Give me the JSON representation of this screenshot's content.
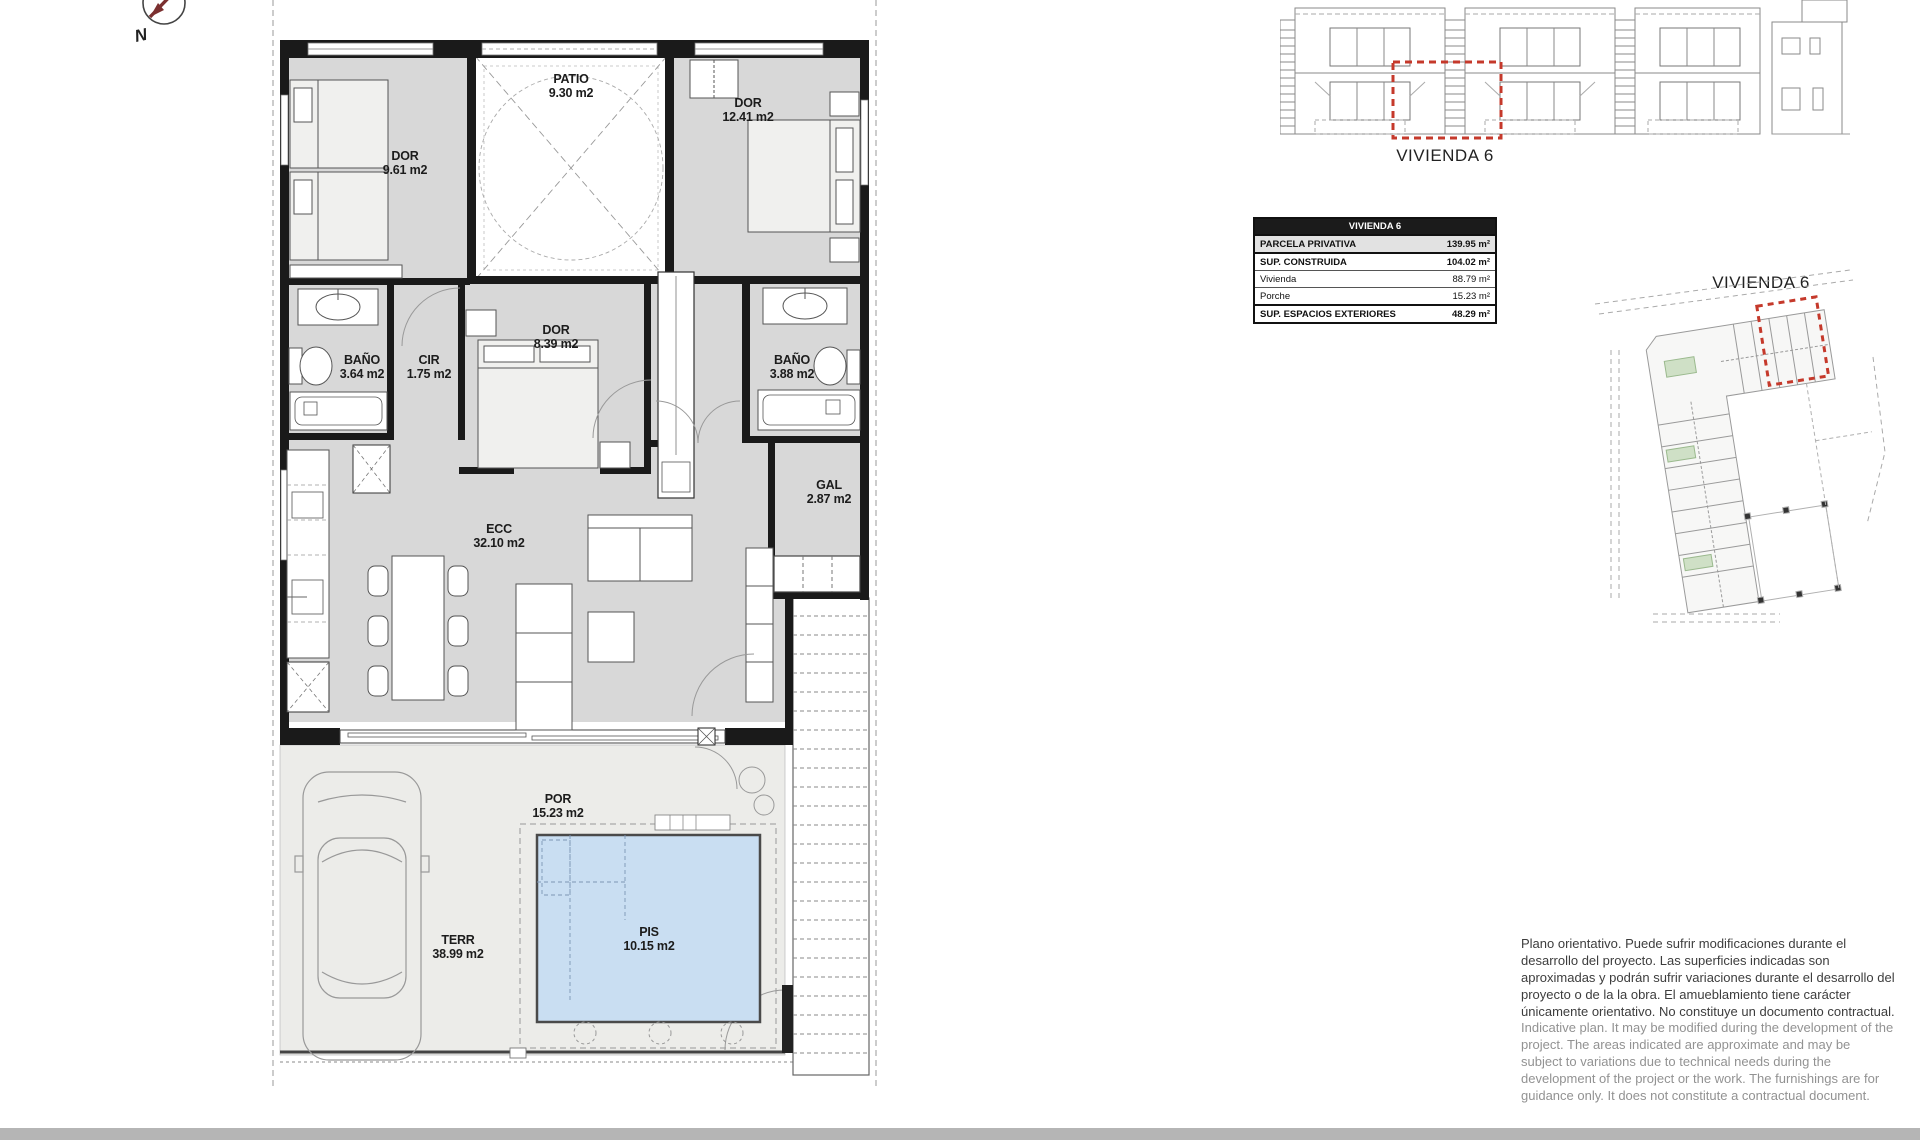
{
  "compass": {
    "north_label": "N"
  },
  "plan": {
    "rooms": [
      {
        "name": "DOR",
        "area": "9.61 m2"
      },
      {
        "name": "PATIO",
        "area": "9.30 m2"
      },
      {
        "name": "DOR",
        "area": "12.41 m2"
      },
      {
        "name": "DOR",
        "area": "8.39 m2"
      },
      {
        "name": "BAÑO",
        "area": "3.64 m2"
      },
      {
        "name": "CIR",
        "area": "1.75 m2"
      },
      {
        "name": "BAÑO",
        "area": "3.88 m2"
      },
      {
        "name": "GAL",
        "area": "2.87 m2"
      },
      {
        "name": "ECC",
        "area": "32.10 m2"
      },
      {
        "name": "POR",
        "area": "15.23 m2"
      },
      {
        "name": "TERR",
        "area": "38.99 m2"
      },
      {
        "name": "PIS",
        "area": "10.15 m2"
      }
    ]
  },
  "elevation": {
    "caption": "VIVIENDA 6"
  },
  "site_plan": {
    "caption": "VIVIENDA 6"
  },
  "summary_table": {
    "header": "VIVIENDA 6",
    "rows": [
      {
        "label": "PARCELA PRIVATIVA",
        "value": "139.95 m²"
      },
      {
        "label": "SUP. CONSTRUIDA",
        "value": "104.02 m²"
      },
      {
        "label": "Vivienda",
        "value": "88.79 m²"
      },
      {
        "label": "Porche",
        "value": "15.23 m²"
      },
      {
        "label": "SUP. ESPACIOS EXTERIORES",
        "value": "48.29 m²"
      }
    ]
  },
  "disclaimer": {
    "spanish": "Plano orientativo. Puede sufrir modificaciones durante el desarrollo del proyecto. Las superficies indicadas son aproximadas y podrán sufrir variaciones durante el desarrollo del proyecto o de la la obra. El amueblamiento tiene carácter únicamente orientativo. No constituye un documento contractual.",
    "english": "Indicative plan. It may be modified during the development of the project. The areas indicated are approximate and may be subject to variations due to technical needs during the development of the project or the work. The furnishings are for guidance only. It does not constitute a contractual document."
  },
  "colors": {
    "pool_fill": "#c9def2",
    "room_fill": "#d8d8d8",
    "terrace_fill": "#ecece9",
    "wall": "#1a1a1a",
    "accent_red": "#c5392b",
    "footer_bar": "#b5b5b5"
  }
}
